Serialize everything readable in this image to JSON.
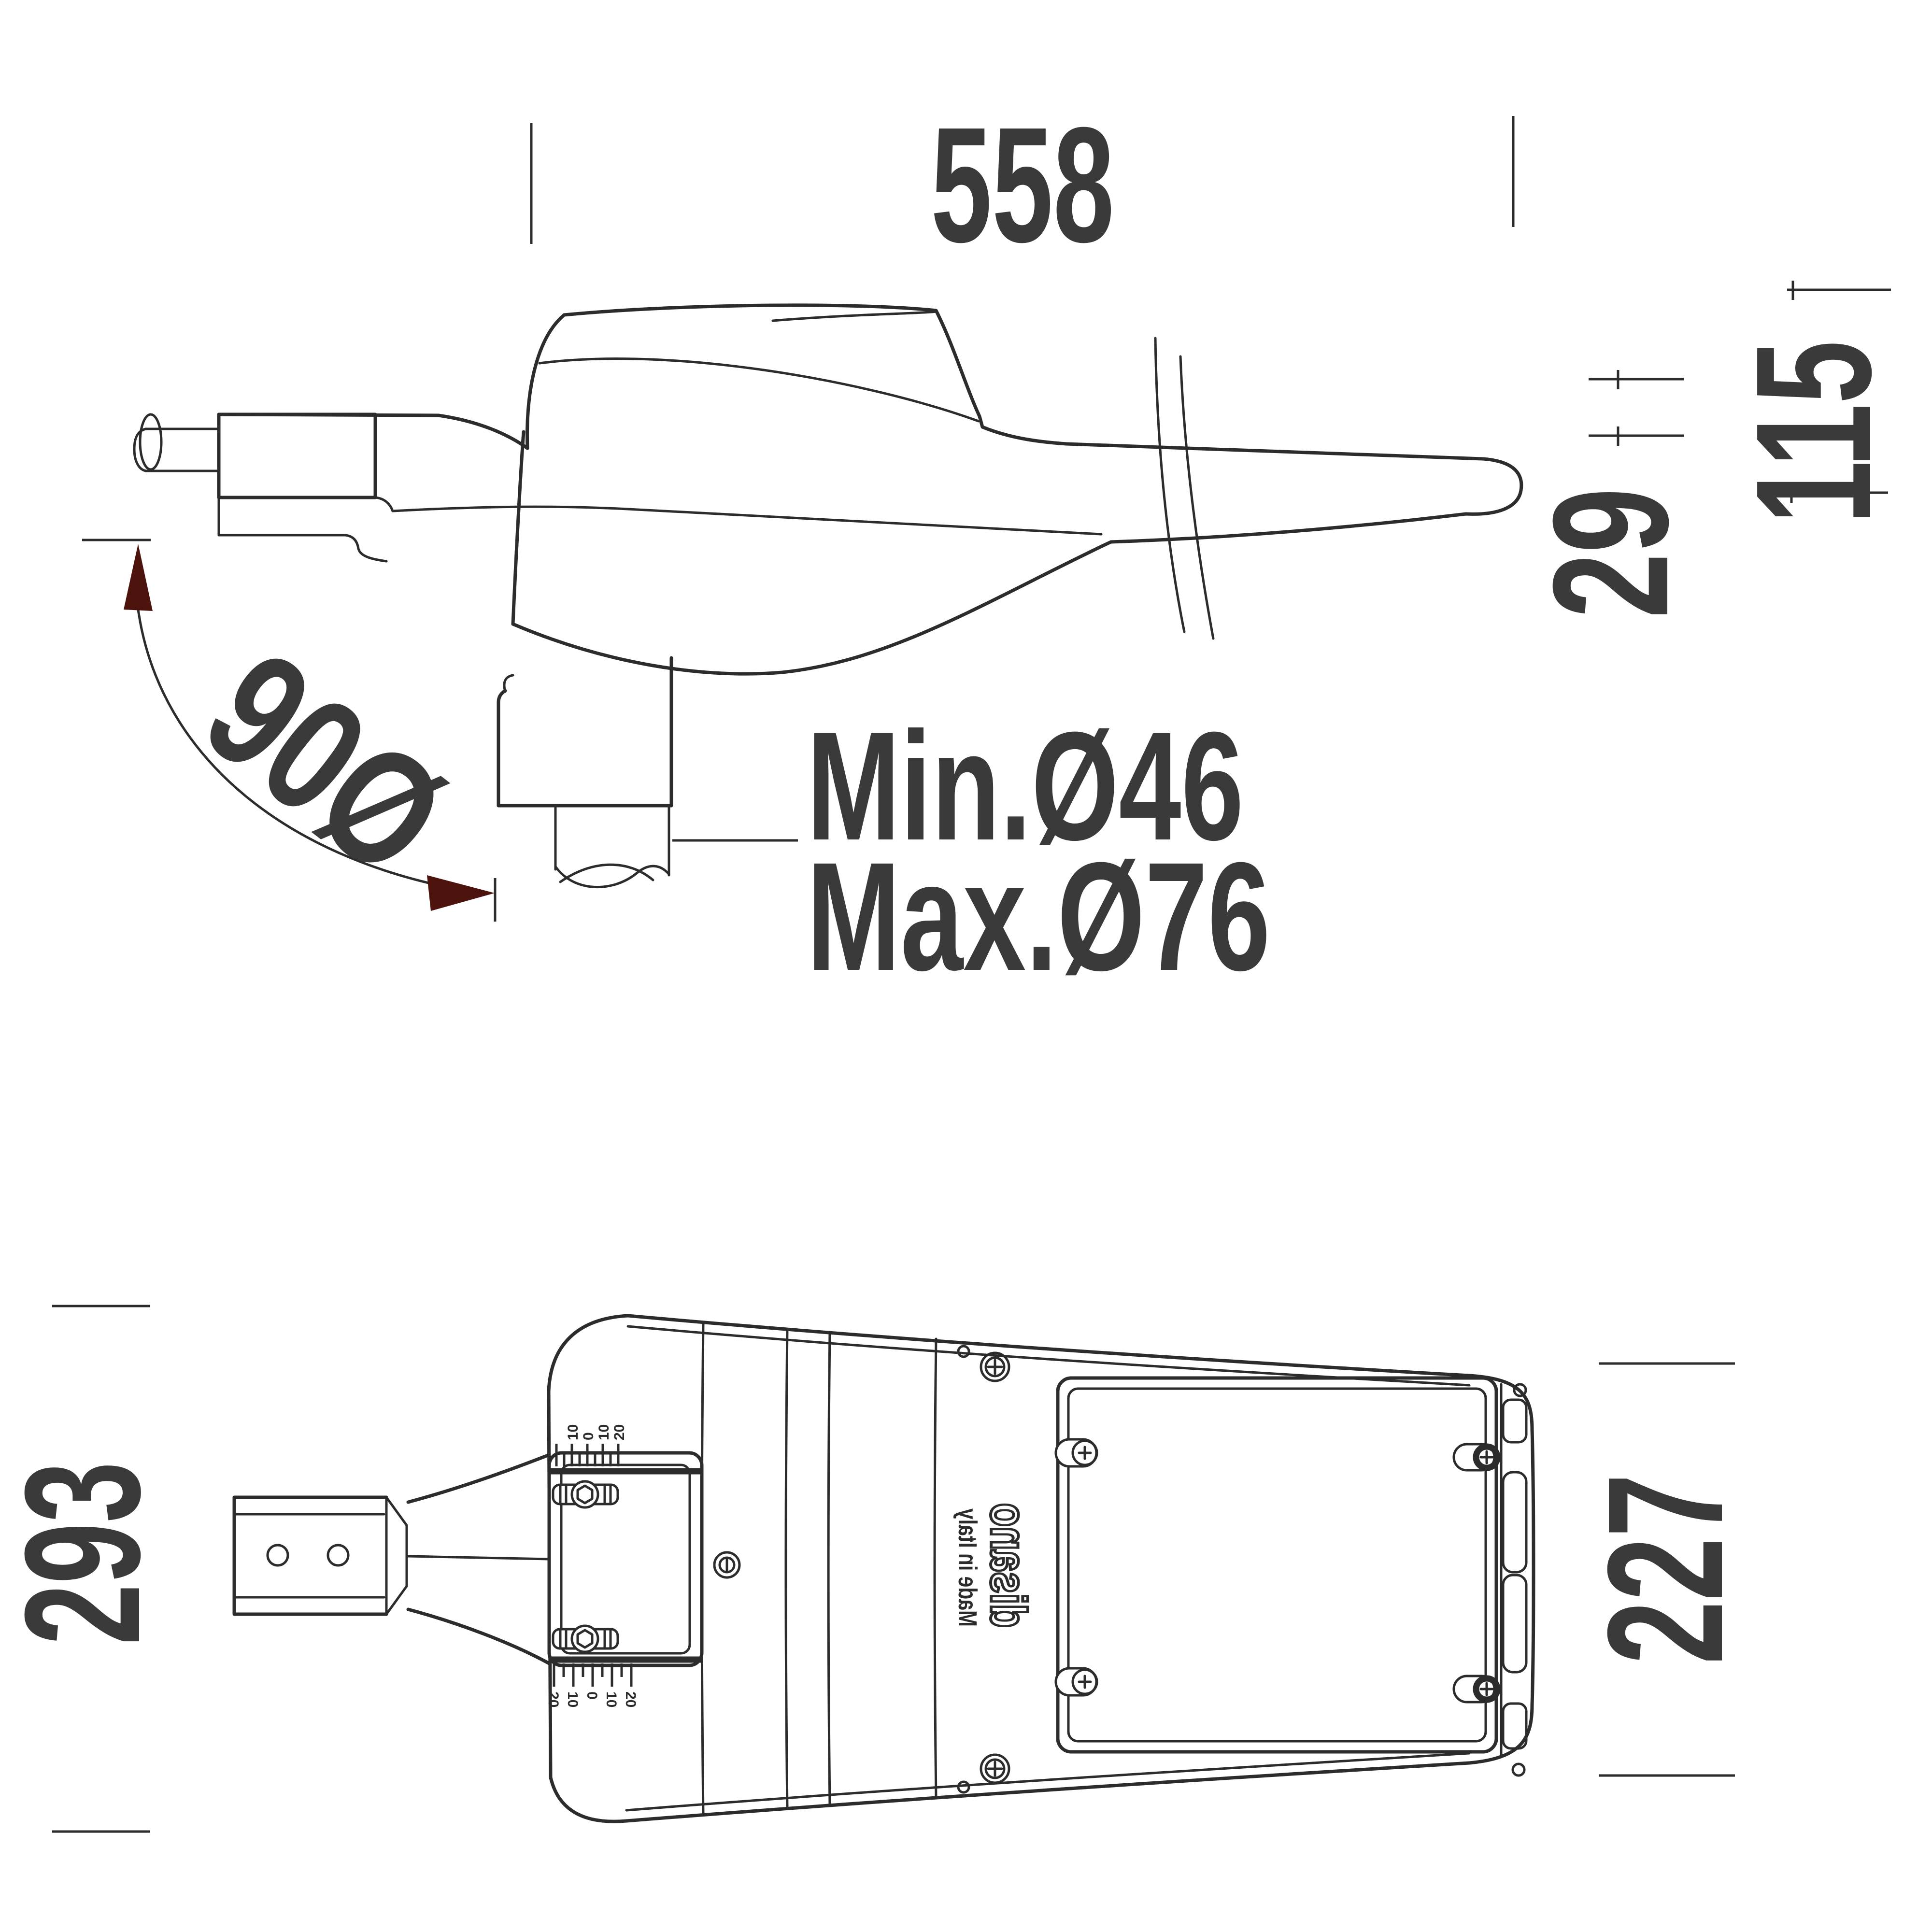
{
  "drawing": {
    "kind": "street-light luminaire dimension drawing",
    "views": {
      "side": "side profile view",
      "bottom": "bottom view"
    }
  },
  "dims": {
    "overall_length": "558",
    "overall_height": "115",
    "tail_height": "29",
    "tilt_angle": "90Ø",
    "pole_min": "Min.Ø46",
    "pole_max": "Max.Ø76",
    "body_width": "293",
    "panel_width": "227"
  },
  "branding": {
    "logo": "disano",
    "origin": "Made in Italy"
  },
  "tilt_scale": {
    "top_labels": [
      "10",
      "0",
      "10",
      "20"
    ],
    "bottom_labels": [
      "20",
      "10",
      "0",
      "10",
      "20"
    ]
  },
  "colors": {
    "line": "#2c2c2c",
    "dimension_text": "#3a3a3a",
    "arrow": "#4c120c",
    "background": "#ffffff"
  }
}
